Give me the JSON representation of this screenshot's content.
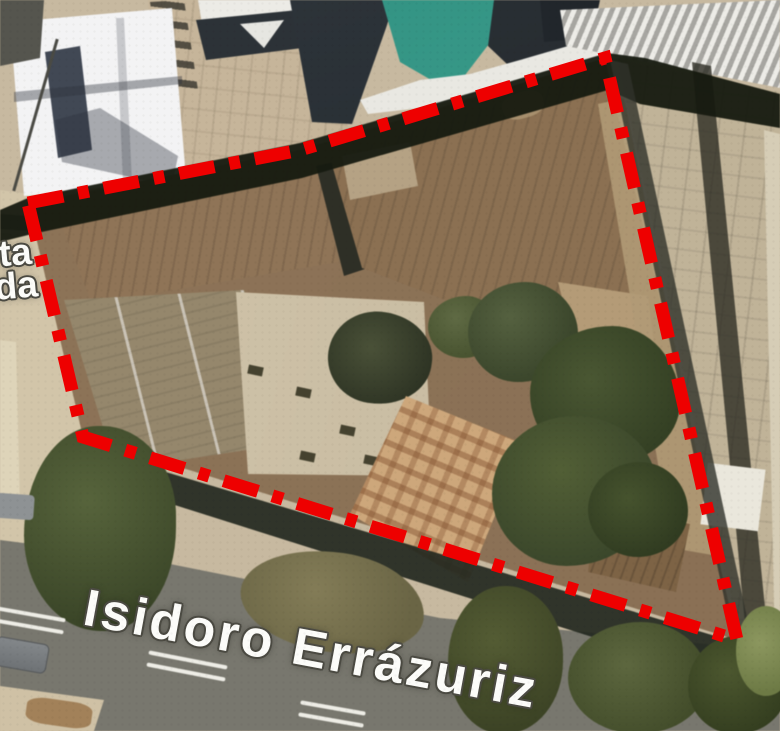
{
  "map": {
    "street_label": "Isidoro Errázuriz",
    "left_street_label": {
      "line1": "ta",
      "line2": "da"
    }
  },
  "annotation": {
    "label": "site-boundary",
    "style": "dash-dot",
    "color": "#ee0000"
  },
  "palette": {
    "boundary_red": "#ee0000",
    "teal_roof": "#349183",
    "navy_roof": "#262d32",
    "white_roof": "#f3f3f4",
    "brown_roof": "#8b7053",
    "gray_roof": "#95876c",
    "beige_roof": "#cdc1a8",
    "tile_roof": "#cda77b",
    "tree_green": "#49552e",
    "road_gray": "#78776e",
    "ground_beige": "#c7b9a0"
  }
}
